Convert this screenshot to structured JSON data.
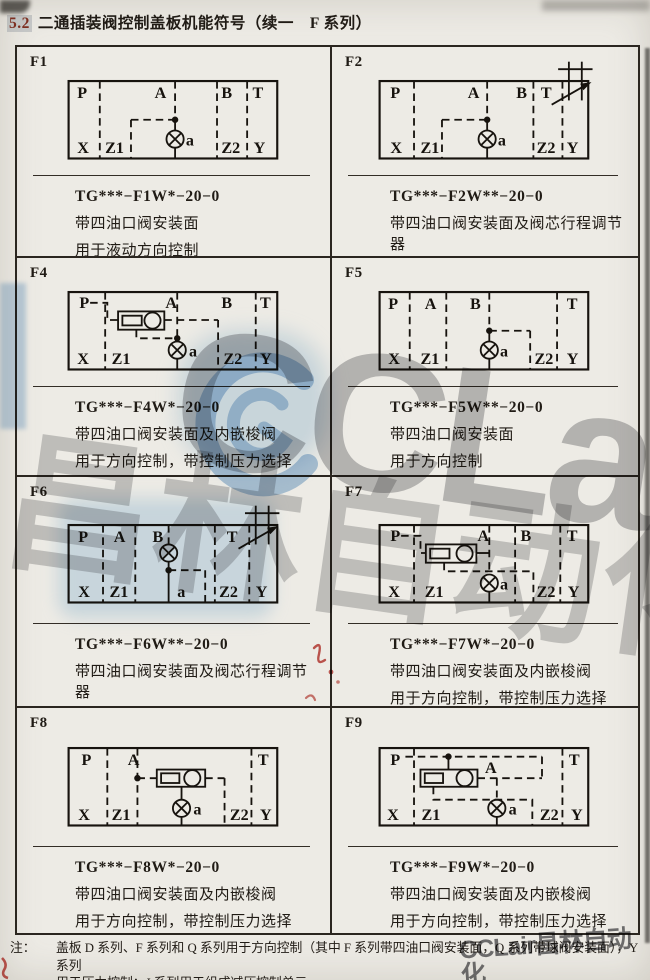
{
  "page": {
    "title_number": "5.2",
    "title_text": "二通插装阀控制盖板机能符号（续一　F 系列）",
    "note_label": "注：",
    "note_line1": "盖板 D 系列、F 系列和 Q 系列用于方向控制（其中 F 系列带四油口阀安装面，Q 系列带球阀安装面），Y 系列",
    "note_line2": "用于压力控制：J 系列用于组成减压控制单元。",
    "watermark_latin": "CCLair",
    "watermark_cn": "昌林自动化",
    "watermark_corner": "CCLair昌林自动化"
  },
  "cells": [
    {
      "id": "F1",
      "model": "TG***−F1W*−20−0",
      "desc1": "带四油口阀安装面",
      "desc2": "用于液动方向控制",
      "ports": {
        "p": "P",
        "a": "A",
        "b": "B",
        "t": "T",
        "x": "X",
        "z1": "Z1",
        "pa": "a",
        "z2": "Z2",
        "y": "Y"
      }
    },
    {
      "id": "F2",
      "model": "TG***−F2W**−20−0",
      "desc1": "带四油口阀安装面及阀芯行程调节器",
      "desc2": "用于方向及节流控制",
      "ports": {
        "p": "P",
        "a": "A",
        "b": "B",
        "t": "T",
        "x": "X",
        "z1": "Z1",
        "pa": "a",
        "z2": "Z2",
        "y": "Y"
      }
    },
    {
      "id": "F4",
      "model": "TG***−F4W*−20−0",
      "desc1": "带四油口阀安装面及内嵌梭阀",
      "desc2": "用于方向控制，带控制压力选择",
      "ports": {
        "p": "P",
        "a": "A",
        "b": "B",
        "t": "T",
        "x": "X",
        "z1": "Z1",
        "pa": "a",
        "z2": "Z2",
        "y": "Y"
      }
    },
    {
      "id": "F5",
      "model": "TG***−F5W**−20−0",
      "desc1": "带四油口阀安装面",
      "desc2": "用于方向控制",
      "ports": {
        "p": "P",
        "a": "A",
        "b": "B",
        "t": "T",
        "x": "X",
        "z1": "Z1",
        "pa": "a",
        "z2": "Z2",
        "y": "Y"
      }
    },
    {
      "id": "F6",
      "model": "TG***−F6W**−20−0",
      "desc1": "带四油口阀安装面及阀芯行程调节器",
      "desc2": "用于方向及节流控制",
      "ports": {
        "p": "P",
        "a": "A",
        "b": "B",
        "t": "T",
        "x": "X",
        "z1": "Z1",
        "pa": "a",
        "z2": "Z2",
        "y": "Y"
      }
    },
    {
      "id": "F7",
      "model": "TG***−F7W*−20−0",
      "desc1": "带四油口阀安装面及内嵌梭阀",
      "desc2": "用于方向控制，带控制压力选择",
      "ports": {
        "p": "P",
        "a": "A",
        "b": "B",
        "t": "T",
        "x": "X",
        "z1": "Z1",
        "pa": "a",
        "z2": "Z2",
        "y": "Y"
      }
    },
    {
      "id": "F8",
      "model": "TG***−F8W*−20−0",
      "desc1": "带四油口阀安装面及内嵌梭阀",
      "desc2": "用于方向控制，带控制压力选择",
      "ports": {
        "p": "P",
        "a": "A",
        "t": "T",
        "x": "X",
        "z1": "Z1",
        "pa": "a",
        "z2": "Z2",
        "y": "Y"
      }
    },
    {
      "id": "F9",
      "model": "TG***−F9W*−20−0",
      "desc1": "带四油口阀安装面及内嵌梭阀",
      "desc2": "用于方向控制，带控制压力选择",
      "ports": {
        "p": "P",
        "a": "A",
        "t": "T",
        "x": "X",
        "z1": "Z1",
        "pa": "a",
        "z2": "Z2",
        "y": "Y"
      }
    }
  ]
}
